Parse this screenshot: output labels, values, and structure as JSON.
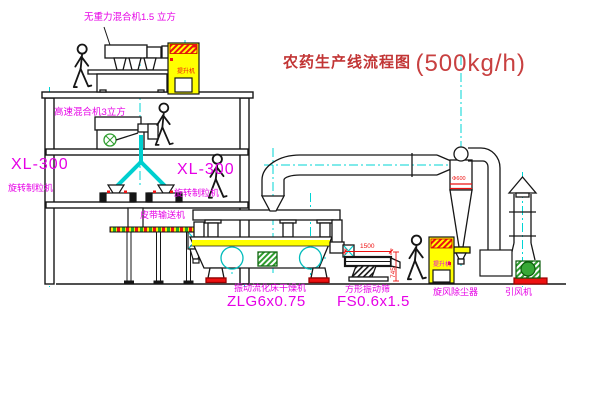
{
  "title": {
    "name": "农药生产线流程图",
    "capacity": "(500kg/h)"
  },
  "labels": {
    "gravity_free_mixer": "无重力混合机1.5 立方",
    "high_speed_mixer": "高速混合机3立方",
    "granulator_left_model": "XL-300",
    "granulator_left_name": "旋转制粒机",
    "granulator_right_model": "XL-300",
    "granulator_right_name": "旋转制粒机",
    "belt_conveyor": "皮带输送机",
    "fluid_bed_dryer_name": "振动流化床干燥机",
    "fluid_bed_dryer_model": "ZLG6x0.75",
    "square_sieve_name": "方形振动筛",
    "square_sieve_model": "FS0.6x1.5",
    "cyclone_name": "旋风除尘器",
    "induced_fan_name": "引风机",
    "elevator1_text": "提升机",
    "elevator2_text": "提升机",
    "cyclone_spec": "Φ600",
    "dimension_width": "1500",
    "dimension_height": "745"
  },
  "colors": {
    "label_magenta": "#e600e6",
    "title_red": "#c23535",
    "dimension_red": "#ee1111",
    "centerline_cyan": "#00d5d5",
    "equipment_yellow": "#ffff00",
    "motor_green": "#2f9e2f",
    "line_black": "#161616"
  }
}
